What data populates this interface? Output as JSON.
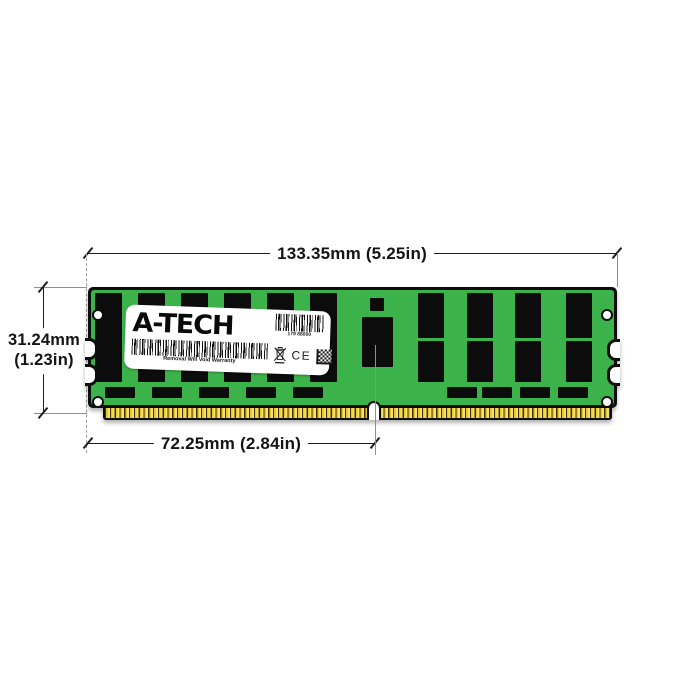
{
  "figure": {
    "type": "product-dimension-diagram",
    "subject": "A-Tech DDR4 LRDIMM server memory module, front view with measurements"
  },
  "dimensions": {
    "width_label": "133.35mm (5.25in)",
    "height_label_line1": "31.24mm",
    "height_label_line2": "(1.23in)",
    "pin_span_label": "72.25mm (2.84in)"
  },
  "label": {
    "logo_text": "A-TECH",
    "serial_text": "179 88000",
    "warranty_text": "Removal Will Void Warranty",
    "ce_text": "CE",
    "marks": [
      "weee-crossed-bin",
      "ce-mark",
      "qr-code"
    ]
  },
  "colors": {
    "pcb_green": "#3cb24a",
    "chip_black": "#0c0c0c",
    "gold_pins": "#e7c72e",
    "label_white": "#ffffff",
    "dimension_line": "#1d1d1d"
  },
  "module": {
    "chips": [
      [
        7,
        6,
        27,
        89
      ],
      [
        50,
        6,
        27,
        89
      ],
      [
        93,
        6,
        27,
        89
      ],
      [
        136,
        6,
        27,
        89
      ],
      [
        179,
        6,
        27,
        89
      ],
      [
        222,
        6,
        27,
        89
      ],
      [
        282,
        11,
        14,
        13
      ],
      [
        274,
        30,
        31,
        50
      ],
      [
        330,
        6,
        26,
        45
      ],
      [
        379,
        6,
        26,
        45
      ],
      [
        427,
        6,
        26,
        45
      ],
      [
        478,
        6,
        26,
        45
      ],
      [
        330,
        54,
        26,
        41
      ],
      [
        379,
        54,
        26,
        41
      ],
      [
        427,
        54,
        26,
        41
      ],
      [
        478,
        54,
        26,
        41
      ],
      [
        17,
        100,
        30,
        11
      ],
      [
        64,
        100,
        30,
        11
      ],
      [
        111,
        100,
        30,
        11
      ],
      [
        158,
        100,
        30,
        11
      ],
      [
        205,
        100,
        30,
        11
      ],
      [
        359,
        100,
        30,
        11
      ],
      [
        394,
        100,
        30,
        11
      ],
      [
        432,
        100,
        30,
        11
      ],
      [
        470,
        100,
        30,
        11
      ]
    ]
  }
}
